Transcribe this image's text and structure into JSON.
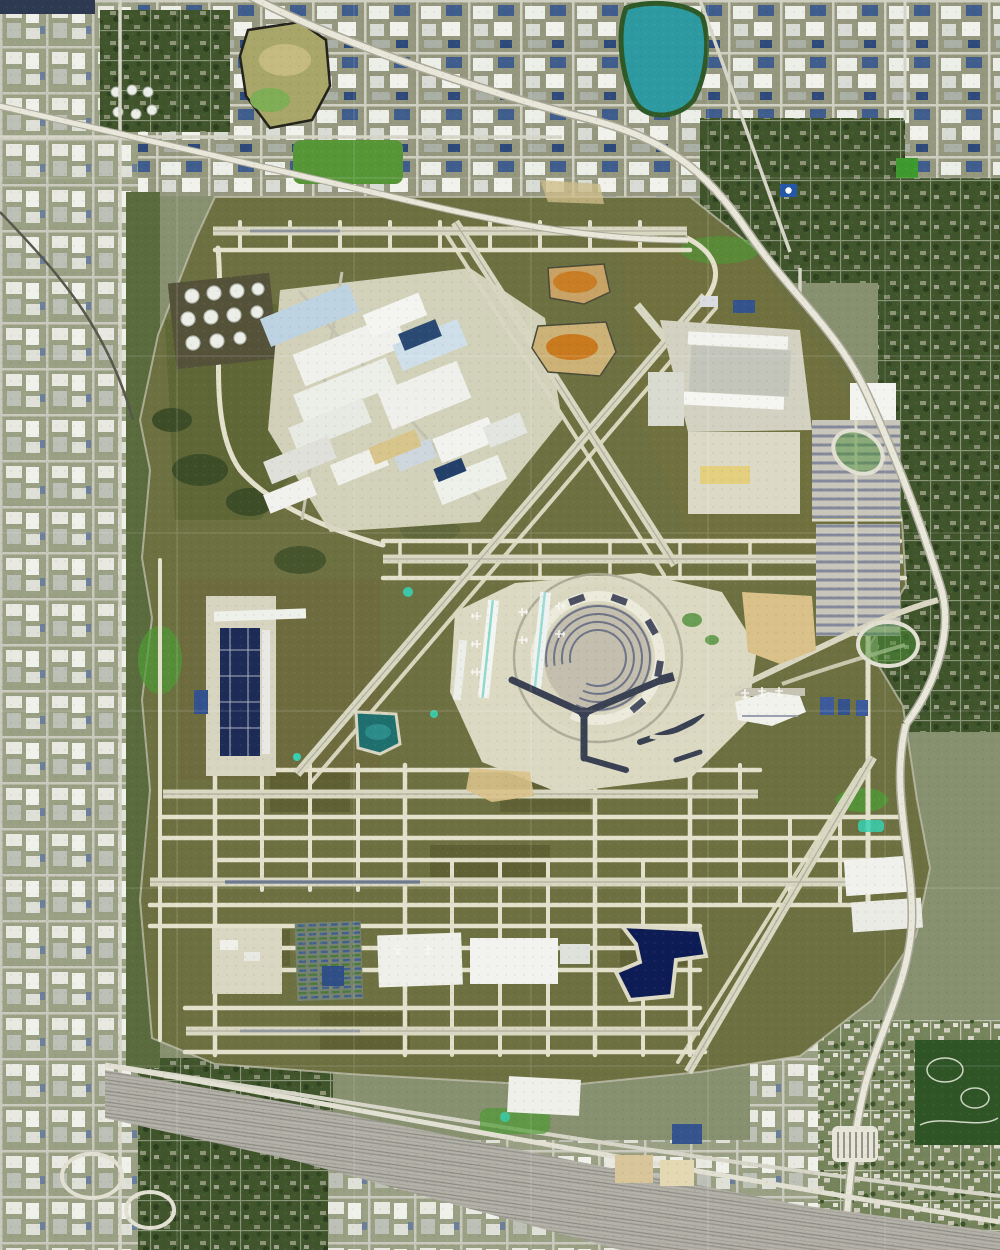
{
  "meta": {
    "title": "Aerial satellite view of a major international airport",
    "width": 1000,
    "height": 1250,
    "description": "Top-down orthographic satellite photograph. A large airport with six east-west runways and diagonal crossing runways occupies the center, ringed by industrial and residential street grid, expressways, a rail yard across the bottom, a teal lake at top and a navy retention pond in the southeast airfield."
  },
  "palette": {
    "urban_base": "#87906f",
    "airport_grass": "#6d7040",
    "grass_dark": "#5b5d31",
    "pavement": "#e3e1cb",
    "runway": "#d8d7c1",
    "concrete_bright": "#efeede",
    "terminal_roof_dark": "#3a4152",
    "teal_accent": "#37d0b2",
    "lake_teal": "#2d9aa2",
    "pond_navy": "#0e1c55",
    "pond_teal_small": "#1f6f6f",
    "basin_orange": "#c97a1e",
    "basin_tan": "#cdb277",
    "sand_tan": "#d9c189",
    "rail_yard": "#b3b1a8",
    "highway": "#e9e7d9",
    "trees_dark": "#41552c",
    "construction_navy": "#1d2b57",
    "warehouse_blue": "#34528c"
  },
  "scene": {
    "type": "satellite-photo",
    "features": [
      {
        "name": "airport-grounds",
        "description": "Olive-grass airfield occupying the center of the frame"
      },
      {
        "name": "runways",
        "description": "Parallel east-west runways north, center and south plus diagonal NE-SW and NW-SE runways"
      },
      {
        "name": "terminal-complex",
        "description": "Central horseshoe terminal with fan-shaped parking rows, twin concourse strips and dark Y-shaped pier"
      },
      {
        "name": "cargo-city-north",
        "description": "Angled cluster of white cargo and maintenance hangars in the northwest quadrant"
      },
      {
        "name": "fuel-tank-farm",
        "description": "Rows of circular white fuel storage tanks"
      },
      {
        "name": "west-construction-site",
        "description": "Long navy-roofed building under construction on the west apron"
      },
      {
        "name": "south-cargo",
        "description": "Freight buildings and colorful intermodal container rows south of the runways"
      },
      {
        "name": "east-parking-lots",
        "description": "Striped economy car parking lots along the east boundary"
      },
      {
        "name": "quarry-lake",
        "description": "Teal lake ringed by trees at top center"
      },
      {
        "name": "retention-pond-navy",
        "description": "Angular dark navy retention pond in the southeast airfield"
      },
      {
        "name": "sediment-basins",
        "description": "Two tan basins with orange sediment north of the terminal"
      },
      {
        "name": "expressway",
        "description": "Multi-lane expressway sweeping from top left along the northeast airport boundary"
      },
      {
        "name": "toll-plaza",
        "description": "Toll plaza on the north-south tollway at lower right"
      },
      {
        "name": "rail-yard",
        "description": "Wide diagonal railroad classification yard across the bottom of the frame"
      },
      {
        "name": "urban-grid",
        "description": "Surrounding industrial blocks, tree-covered residential grid and parks"
      }
    ]
  }
}
